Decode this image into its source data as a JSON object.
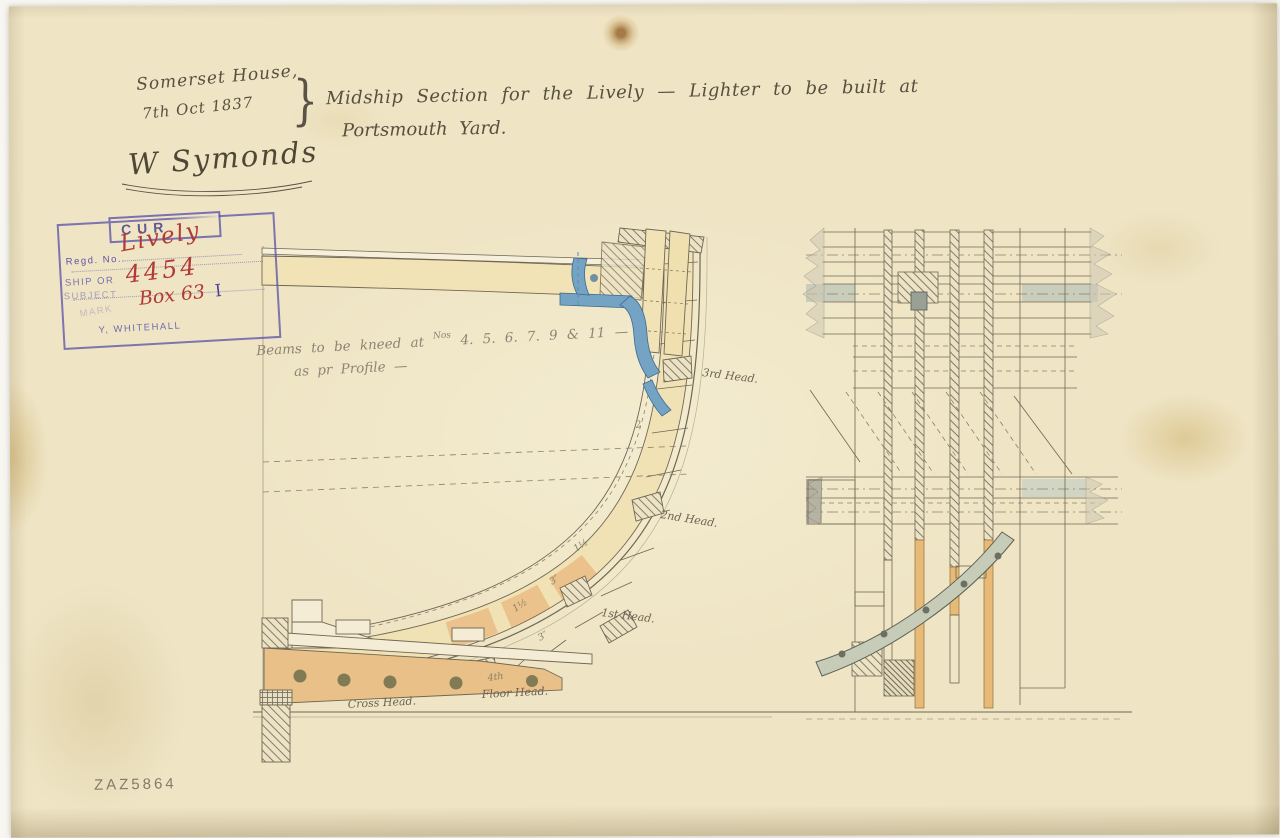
{
  "header": {
    "office": "Somerset House,",
    "date": "7th Oct 1837",
    "brace": "}",
    "title_line1": "Midship Section for the Lively — Lighter to be built at",
    "title_line2": "Portsmouth Yard.",
    "signature": "W Symonds"
  },
  "stamp": {
    "header_partial": "CUR",
    "line_regd": "Regd. No.",
    "line_ship": "SHIP OR",
    "line_subject": "SUBJECT",
    "line_mark": "MARK",
    "line_whitehall": "Y, WHITEHALL",
    "entry_name": "Lively",
    "entry_number": "4454",
    "entry_box": "Box 63",
    "entry_roman": "I"
  },
  "note": {
    "line1_pre": "Beams to be kneed at",
    "line1_sup": "Nos",
    "line1_nums": "4. 5. 6. 7. 9 & 11 —",
    "line2": "as pr Profile —"
  },
  "section_labels": {
    "head3": "3rd Head.",
    "head2": "2nd Head.",
    "head1": "1st Head.",
    "floor_head": "Floor Head.",
    "cross_head": "Cross Head.",
    "dim_2": "2",
    "dim_15a": "1½",
    "dim_3a": "3″",
    "dim_15b": "1½",
    "dim_3b": "3″",
    "dim_4th": "4th"
  },
  "archive_ref": "ZAZ5864",
  "colors": {
    "paper": "#efe5c5",
    "ink": "#6f6754",
    "wood_tan": "#f2e3b6",
    "floor_orange": "#eac089",
    "iron_blue": "#74a3c4",
    "knee_gray": "#c7ccb9",
    "stamp_purple": "#5d54aa",
    "entry_red": "#b23a36",
    "pencil": "#8d8474"
  }
}
